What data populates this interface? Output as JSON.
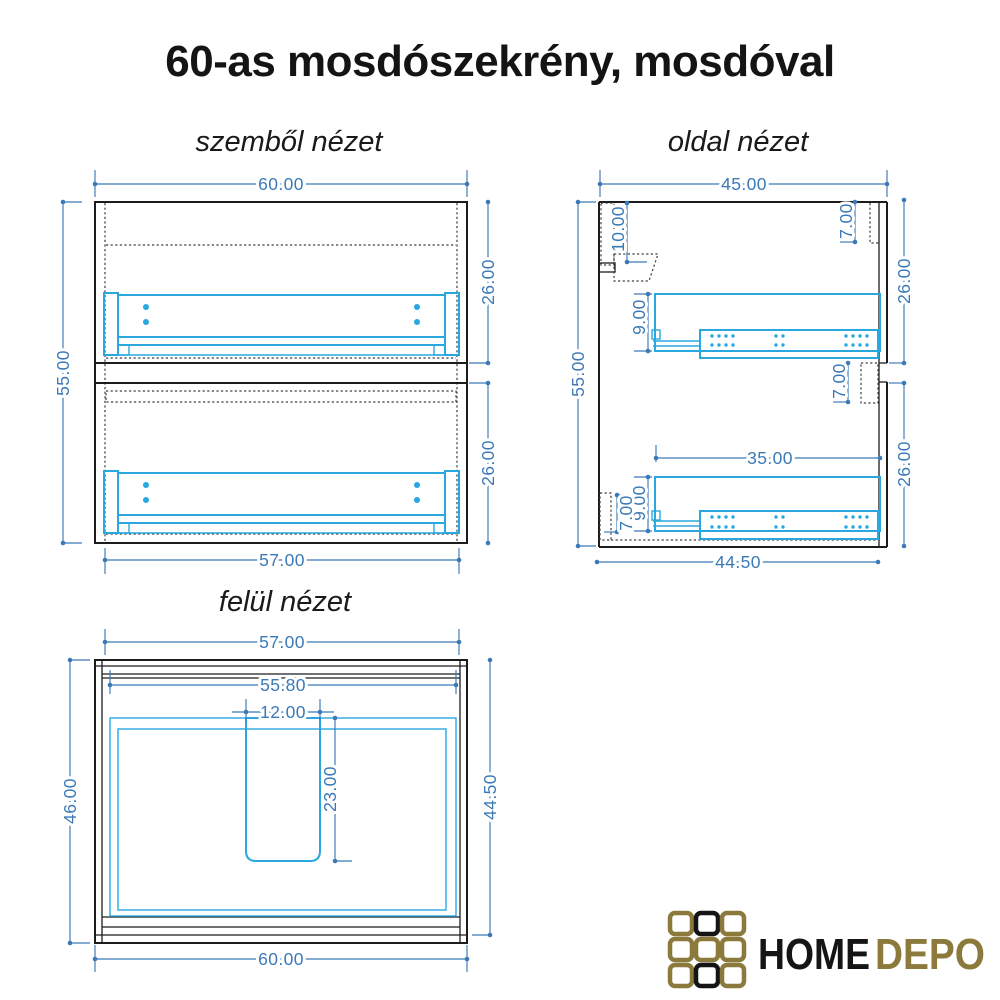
{
  "title": "60-as mosdószekrény, mosdóval",
  "views": {
    "front": {
      "label": "szemből nézet",
      "dims": {
        "width_top": "60.00",
        "height_left": "55.00",
        "upper_section_right": "26.00",
        "lower_section_right": "26.00",
        "width_bottom": "57.00"
      }
    },
    "side": {
      "label": "oldal nézet",
      "dims": {
        "depth_top": "45.00",
        "height_left": "55.00",
        "sink_cutout_depth": "10.00",
        "top_back_panel": "7.00",
        "upper_section_right": "26.00",
        "upper_rail_height": "9.00",
        "mid_back_panel": "7.00",
        "drawer_depth": "35.00",
        "lower_rail_height": "9.00",
        "plinth_height": "7.00",
        "lower_section_right": "26.00",
        "depth_bottom": "44.50"
      }
    },
    "top": {
      "label": "felül nézet",
      "dims": {
        "width_top": "57.00",
        "inner_width": "55.80",
        "cutout_width": "12.00",
        "cutout_depth": "23.00",
        "depth_left": "46.00",
        "depth_right": "44.50",
        "width_bottom": "60.00"
      }
    }
  },
  "logo": {
    "home": "HOME",
    "depo": "DEPO"
  },
  "colors": {
    "dimension_blue": "#3b79b7",
    "drawing_cyan": "#29a8e0",
    "outline_black": "#1c1c1c",
    "logo_gold": "#8b7a3b",
    "logo_black": "#151515",
    "background": "#ffffff"
  }
}
